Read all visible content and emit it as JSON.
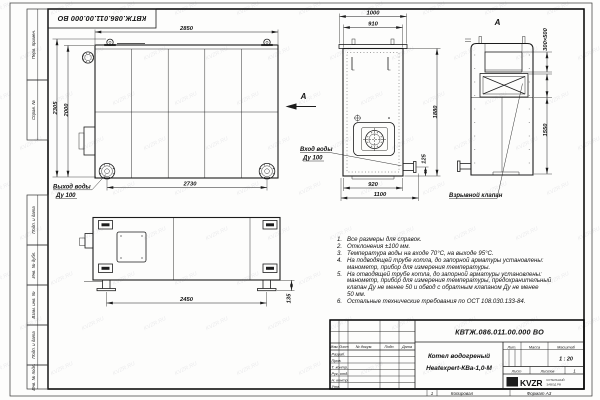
{
  "designation": "КВТЖ.086.011.00.000 ВО",
  "sheet": {
    "margin": {
      "b1": "Перв. примен.",
      "b2": "Справ. №",
      "b3": "Подп. и дата",
      "b4": "Инв. № дубл.",
      "b5": "Взам. инв. №",
      "b6": "Подп. и дата",
      "b7": "Инв. № подл."
    },
    "bottom": {
      "num": "1",
      "copy": "Копировал",
      "format": "Формат А3"
    }
  },
  "views": {
    "view_letter": "А",
    "front": {
      "dims": {
        "top": "2850",
        "left_outer": "2305",
        "left_inner": "2000",
        "bottom": "2730"
      },
      "labels": {
        "outlet1": "Выход воды",
        "outlet2": "Ду 100"
      }
    },
    "side": {
      "dims": {
        "top_outer": "1000",
        "top_inner": "910",
        "right": "1880",
        "pipe": "125",
        "bottom_inner": "920",
        "bottom_outer": "1100"
      },
      "labels": {
        "inlet1": "Вход воды",
        "inlet2": "Ду 100"
      }
    },
    "rear": {
      "title": "А",
      "dims": {
        "flue": "300×500",
        "height": "1550"
      },
      "labels": {
        "valve": "Взрывной клапан"
      }
    },
    "plan": {
      "dims": {
        "length": "2450",
        "leg_height": "135"
      }
    }
  },
  "notes": {
    "items": [
      {
        "num": "1.",
        "text": "Все размеры для справок."
      },
      {
        "num": "2.",
        "text": "Отклонения ±100 мм."
      },
      {
        "num": "3.",
        "text": "Температура воды на входе 70°С, на выходе 95°С."
      },
      {
        "num": "4.",
        "text": "На подводящей трубе котла, до запорной арматуры установлены:"
      },
      {
        "num": "",
        "text": "манометр, прибор для измерения температуры."
      },
      {
        "num": "5.",
        "text": "На отводящей трубе котла, до запорной арматуры установлены:"
      },
      {
        "num": "",
        "text": "манометр, прибор для измерения температуры, предохранительный"
      },
      {
        "num": "",
        "text": "клапан Ду не менее 50 и обвод с обратным клапаном Ду не менее"
      },
      {
        "num": "",
        "text": "50 мм."
      },
      {
        "num": "6.",
        "text": "Остальные технические требования по ОСТ 108.030.133-84."
      }
    ]
  },
  "title_block": {
    "designation": "КВТЖ.086.011.00.000 ВО",
    "name_line1": "Котел водогреный",
    "name_line2": "Heatexpert-КВа-1,0-М",
    "headers": {
      "izm": "Изм.",
      "list": "Лист",
      "doc": "№ докум.",
      "podp": "Подп.",
      "data": "Дата",
      "lit": "Лит.",
      "massa": "Масса",
      "masshtab": "Масштаб",
      "list2": "Лист",
      "listov": "Листов"
    },
    "rows": {
      "r1": "Разраб.",
      "r2": "Пров.",
      "r3": "Т. контр.",
      "r4": "Рук. отд.",
      "r5": "Н. контр.",
      "r6": "Утв."
    },
    "scale": "1 : 20",
    "sheets_count": "1",
    "logo_text": "KVZR",
    "org_line1": "КОТЕЛЬНЫЙ",
    "org_line2": "ЗАВОД РФ"
  },
  "watermark": {
    "text": "KVZR.RU"
  },
  "colors": {
    "line": "#1c1c1c",
    "text": "#111111"
  }
}
